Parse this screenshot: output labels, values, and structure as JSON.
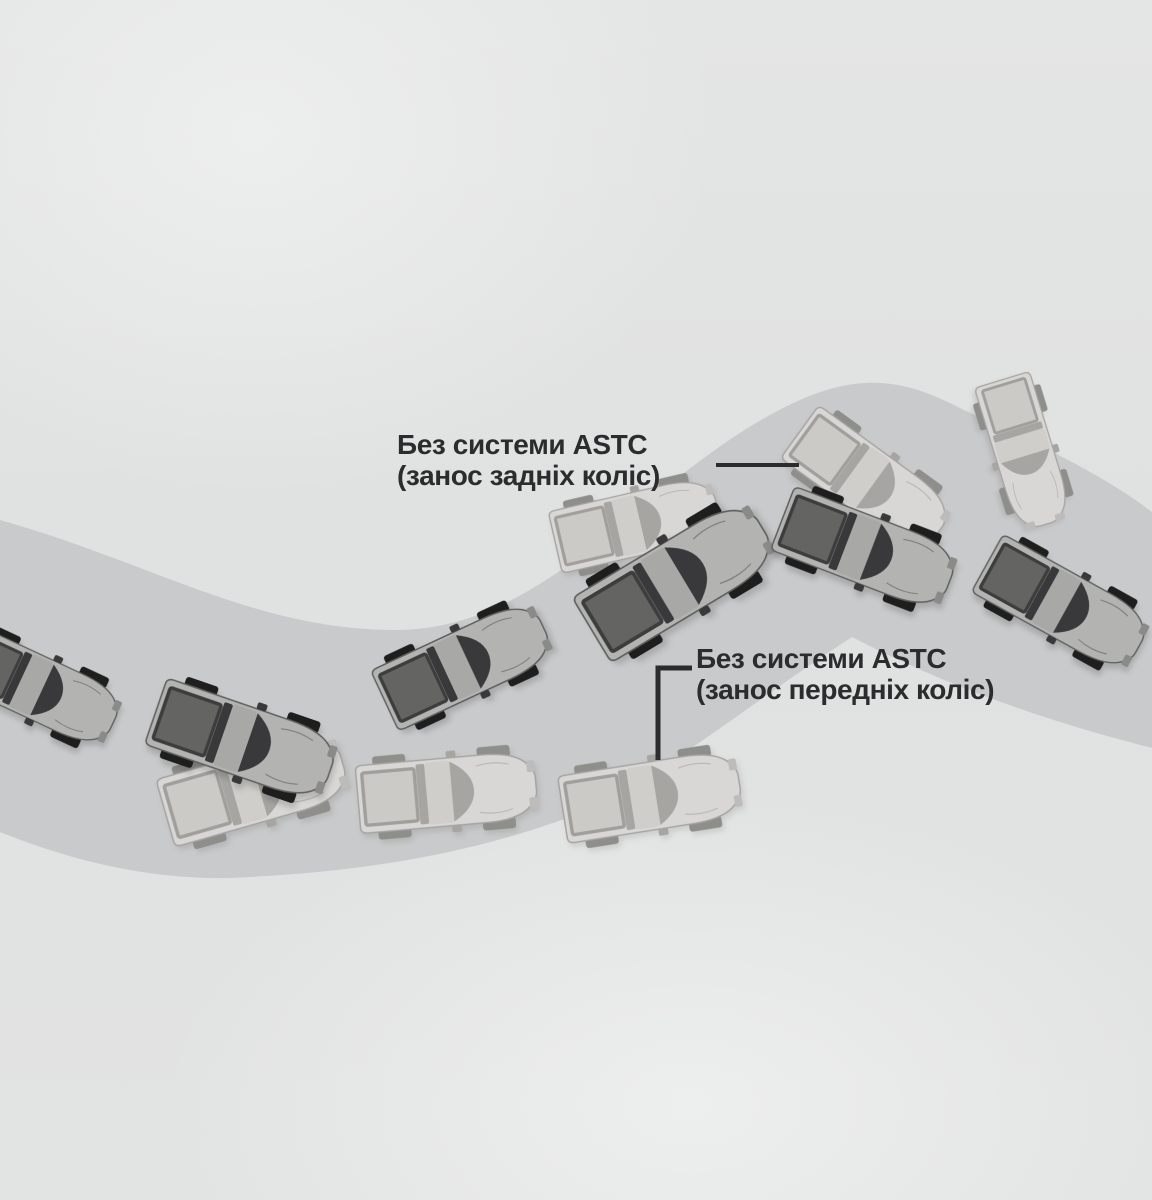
{
  "labels": {
    "rear_skid": {
      "line1": "Без системи ASTC",
      "line2": "(занос задніх коліс)"
    },
    "front_skid": {
      "line1": "Без системи ASTC",
      "line2": "(занос передніх коліс)"
    }
  },
  "colors": {
    "background_base": "#e0e1e1",
    "background_highlight": "#edeeee",
    "road": "#c9cacb",
    "text": "#2c2c2e",
    "leader": "#2c2c2e",
    "car_dark": {
      "body": "#b3b3b2",
      "outline": "#5f5f5e",
      "bed": "#646463",
      "bedRail": "#3d3d3d",
      "glass": "#39393b",
      "roof": "#a8a8a7",
      "wheel": "#1e1e1e",
      "headlight": "#8a8a89"
    },
    "car_light": {
      "body": "#d8d7d5",
      "outline": "#a5a4a1",
      "bed": "#cbcac6",
      "bedRail": "#a19f9c",
      "glass": "#a6a5a2",
      "roof": "#cfcecb",
      "wheel": "#8e8e8b",
      "headlight": "#bdbcba"
    }
  },
  "cars": [
    {
      "id": "car-exit-left",
      "variant": "dark",
      "x": 38,
      "y": 688,
      "rot": 25,
      "scale": 0.9
    },
    {
      "id": "ghost-valley-1",
      "variant": "light",
      "x": 254,
      "y": 788,
      "rot": -16,
      "scale": 1.0
    },
    {
      "id": "car-valley-1",
      "variant": "dark",
      "x": 243,
      "y": 741,
      "rot": 19,
      "scale": 1.0
    },
    {
      "id": "ghost-valley-2",
      "variant": "light",
      "x": 447,
      "y": 792,
      "rot": -5,
      "scale": 0.97
    },
    {
      "id": "car-valley-2",
      "variant": "dark",
      "x": 464,
      "y": 664,
      "rot": -25,
      "scale": 0.95
    },
    {
      "id": "ghost-valley-3",
      "variant": "light",
      "x": 651,
      "y": 796,
      "rot": -9,
      "scale": 0.97
    },
    {
      "id": "ghost-hill-1",
      "variant": "light",
      "x": 636,
      "y": 524,
      "rot": -13,
      "scale": 0.9
    },
    {
      "id": "car-hill-1",
      "variant": "dark",
      "x": 677,
      "y": 579,
      "rot": -31,
      "scale": 1.08
    },
    {
      "id": "ghost-crest-rear",
      "variant": "light",
      "x": 869,
      "y": 482,
      "rot": 36,
      "scale": 0.93
    },
    {
      "id": "car-crest-1",
      "variant": "dark",
      "x": 866,
      "y": 550,
      "rot": 21,
      "scale": 0.97
    },
    {
      "id": "ghost-crest-spun",
      "variant": "light",
      "x": 1024,
      "y": 452,
      "rot": 73,
      "scale": 0.82
    },
    {
      "id": "car-descent-1",
      "variant": "dark",
      "x": 1063,
      "y": 605,
      "rot": 29,
      "scale": 0.94
    }
  ]
}
